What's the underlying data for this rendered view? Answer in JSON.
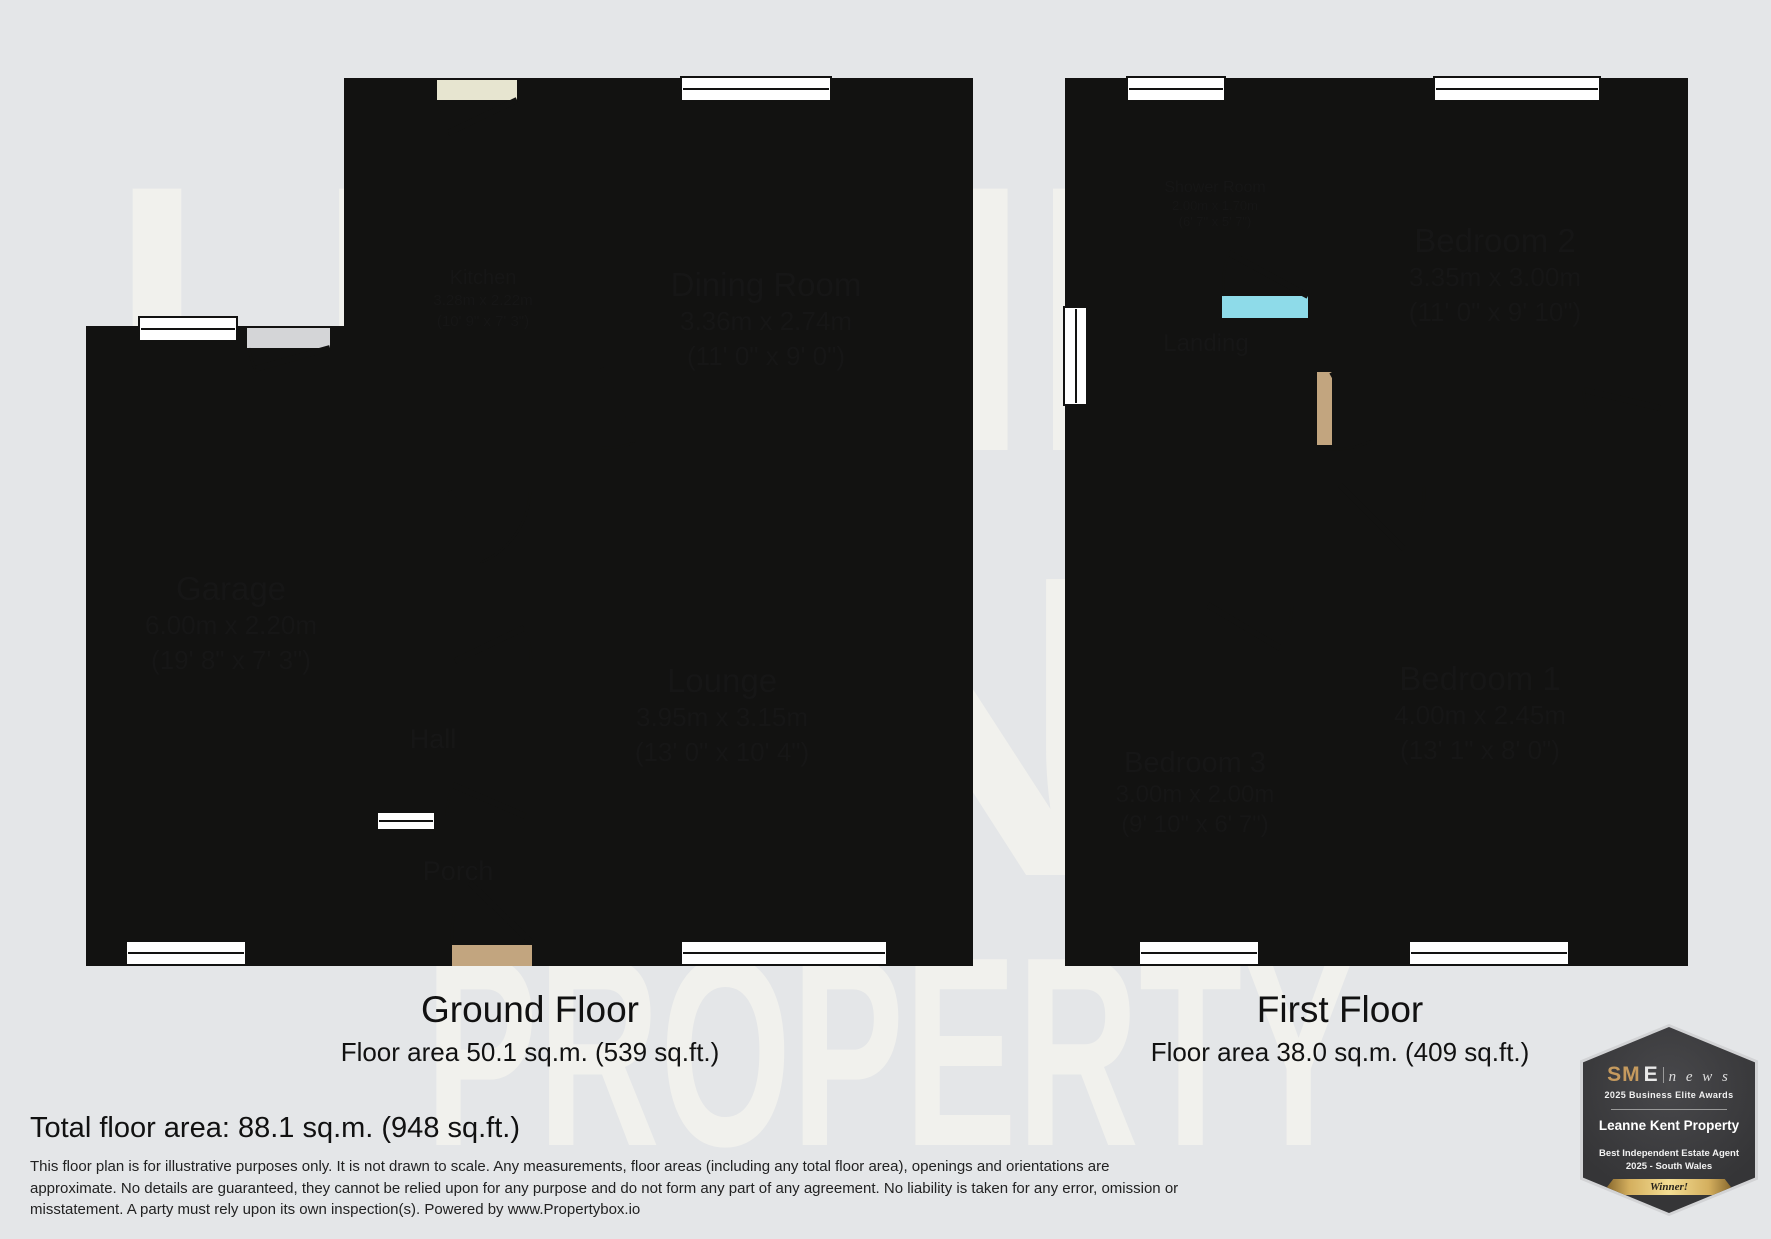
{
  "watermark": {
    "rows": [
      "LEANNE",
      "KENT",
      "PROPERTY"
    ]
  },
  "ground_floor": {
    "title": "Ground Floor",
    "area": "Floor area 50.1 sq.m. (539 sq.ft.)",
    "rooms": {
      "kitchen": {
        "name": "Kitchen",
        "metric": "3.28m x 2.22m",
        "imperial": "(10' 9\" x 7' 3\")"
      },
      "dining": {
        "name": "Dining Room",
        "metric": "3.36m x 2.74m",
        "imperial": "(11' 0\" x 9' 0\")"
      },
      "lounge": {
        "name": "Lounge",
        "metric": "3.95m x 3.15m",
        "imperial": "(13' 0\" x 10' 4\")"
      },
      "garage": {
        "name": "Garage",
        "metric": "6.00m x 2.20m",
        "imperial": "(19' 8\" x 7' 3\")"
      },
      "hall": {
        "name": "Hall"
      },
      "porch": {
        "name": "Porch"
      }
    }
  },
  "first_floor": {
    "title": "First Floor",
    "area": "Floor area 38.0 sq.m. (409 sq.ft.)",
    "rooms": {
      "shower": {
        "name": "Shower Room",
        "metric": "2.00m x 1.70m",
        "imperial": "(6' 7\" x 5' 7\")"
      },
      "bedroom2": {
        "name": "Bedroom 2",
        "metric": "3.35m x 3.00m",
        "imperial": "(11' 0\" x 9' 10\")"
      },
      "bedroom1": {
        "name": "Bedroom 1",
        "metric": "4.00m x 2.45m",
        "imperial": "(13' 1\" x 8' 0\")"
      },
      "bedroom3": {
        "name": "Bedroom 3",
        "metric": "3.00m x 2.00m",
        "imperial": "(9' 10\" x 6' 7\")"
      },
      "landing": {
        "name": "Landing"
      }
    }
  },
  "summary": {
    "total": "Total floor area: 88.1 sq.m. (948 sq.ft.)"
  },
  "disclaimer": {
    "line1": "This floor plan is for illustrative purposes only. It is not drawn to scale. Any measurements, floor areas (including any total floor area), openings and orientations are",
    "line2": "approximate. No details are guaranteed, they cannot be relied upon for any purpose and do not form any part of any agreement. No liability is taken for any error, omission or",
    "line3": "misstatement. A party must rely upon its own inspection(s). Powered by www.Propertybox.io"
  },
  "badge": {
    "brand_bold": "SM",
    "brand_light": "E",
    "brand_news": "n e w s",
    "line1": "2025 Business Elite Awards",
    "name": "Leanne Kent Property",
    "award_line1": "Best Independent Estate Agent",
    "award_line2": "2025 - South Wales",
    "winner": "Winner!"
  },
  "colors": {
    "background": "#e4e6e8",
    "wall": "#121211",
    "cream_room": "#e7e5d0",
    "tan_room": "#c2a57f",
    "bedroom": "#e4d5a1",
    "shower": "#8edbe9",
    "garage": "#d4d5d7",
    "watermark": "#fcf9f0",
    "badge_gold": "#c59a5e"
  }
}
